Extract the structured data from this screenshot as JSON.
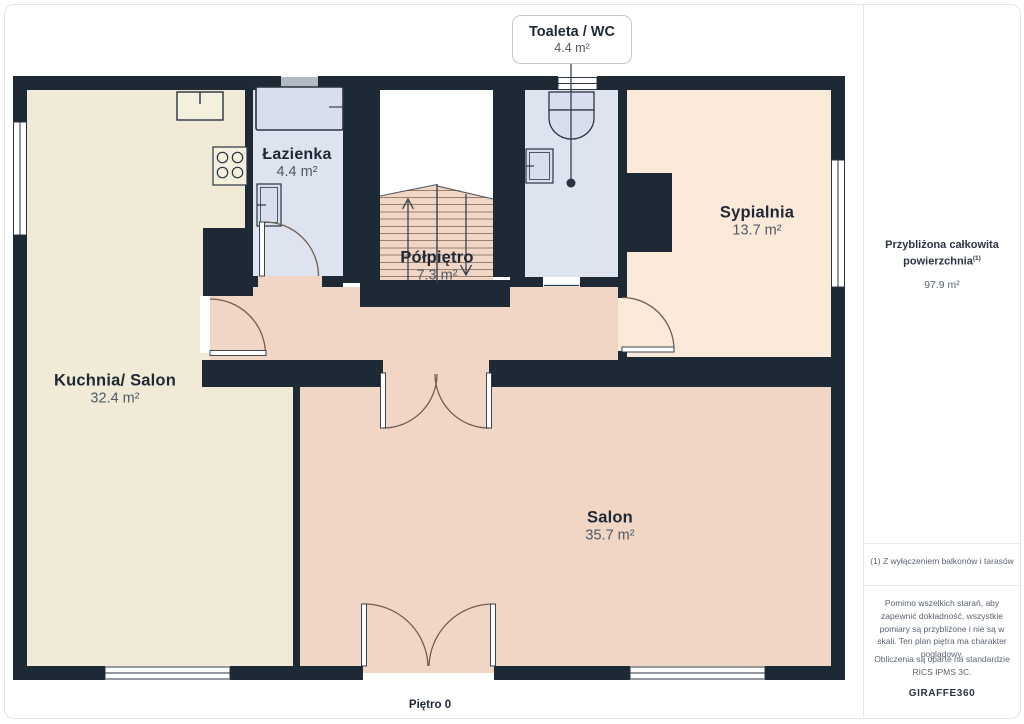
{
  "page": {
    "floor_label": "Piętro 0"
  },
  "callout": {
    "title": "Toaleta / WC",
    "area": "4.4 m²"
  },
  "rooms": {
    "kuchnia": {
      "name": "Kuchnia/ Salon",
      "area": "32.4 m²"
    },
    "lazienka": {
      "name": "Łazienka",
      "area": "4.4 m²"
    },
    "polpietro": {
      "name": "Półpiętro",
      "area": "7.3 m²"
    },
    "sypialnia": {
      "name": "Sypialnia",
      "area": "13.7 m²"
    },
    "salon": {
      "name": "Salon",
      "area": "35.7 m²"
    }
  },
  "sidebar": {
    "total_title_line1": "Przybliżona całkowita",
    "total_title_line2": "powierzchnia",
    "total_title_sup": "(1)",
    "total_value": "97.9 m²",
    "footnote": "(1) Z wyłączeniem balkonów i tarasów",
    "disclaimer": "Pomimo wszelkich starań, aby zapewnić dokładność, wszystkie pomiary są przybliżone i nie są w skali. Ten plan piętra ma charakter poglądowy.",
    "standard_note": "Obliczenia są oparte na standardzie RICS IPMS 3C.",
    "brand_name": "GIRAFFE",
    "brand_number": "360"
  },
  "colors": {
    "wall": "#1e2936",
    "kitchen_floor": "#f0ead6",
    "bath_floor": "#dde3ef",
    "warm_floor": "#f2d6c5",
    "bedroom_floor": "#fbe9d9",
    "accent_text": "#1f2835",
    "muted_text": "#5a6470"
  }
}
